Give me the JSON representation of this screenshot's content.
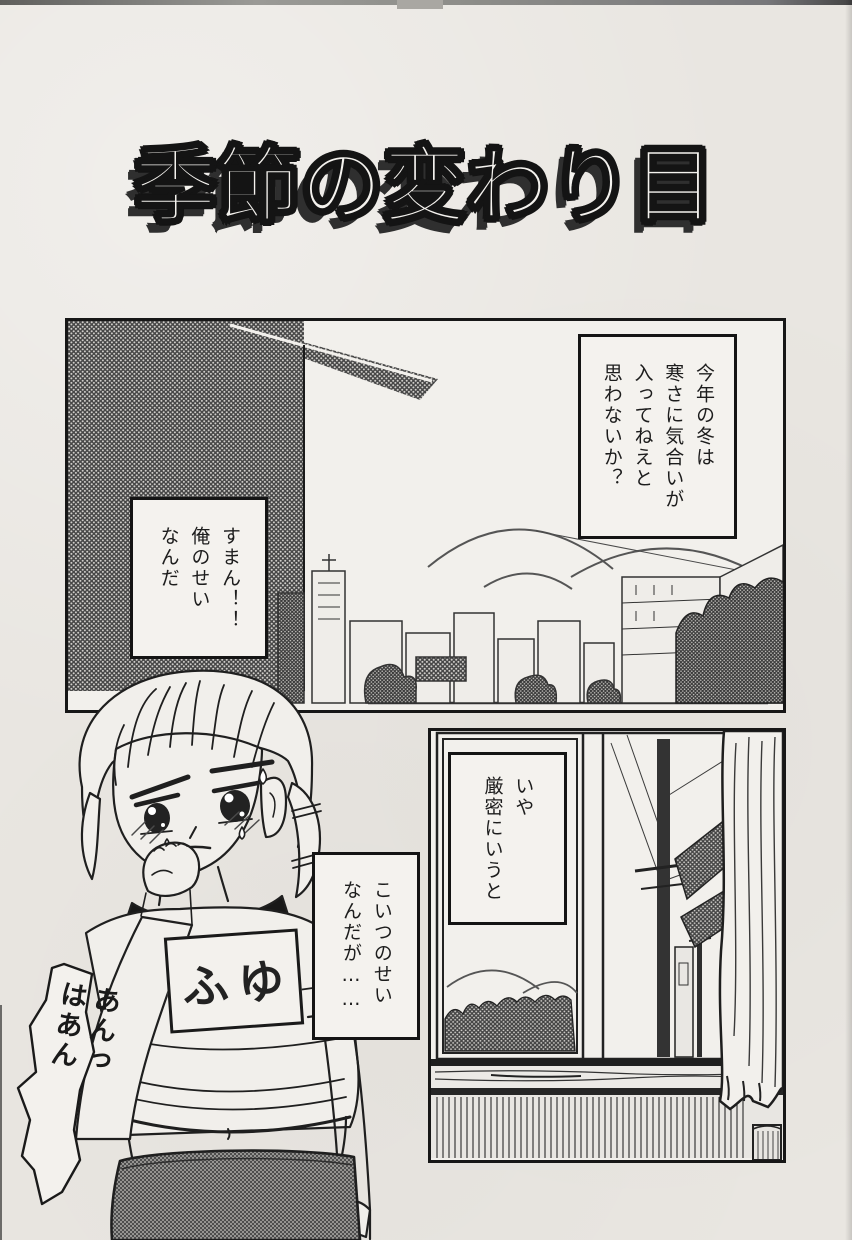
{
  "page": {
    "title": "季節の変わり目",
    "colors": {
      "paper": "#e9e6e1",
      "ink": "#171717",
      "halftone_dark": "#474747"
    }
  },
  "panel1": {
    "bubbles": {
      "winter": "今年の冬は\n寒さに気合いが\n入ってねえと\n思わないか？",
      "sorry": "すまん！！\n俺のせい\nなんだ"
    }
  },
  "panel2": {
    "bubbles": {
      "strictly": "いや\n厳密にいうと"
    }
  },
  "girl": {
    "bubble_blame": "こいつのせい\nなんだが……",
    "shirt_tag": "ふゆ",
    "sfx": "あんっ\nはあん"
  }
}
